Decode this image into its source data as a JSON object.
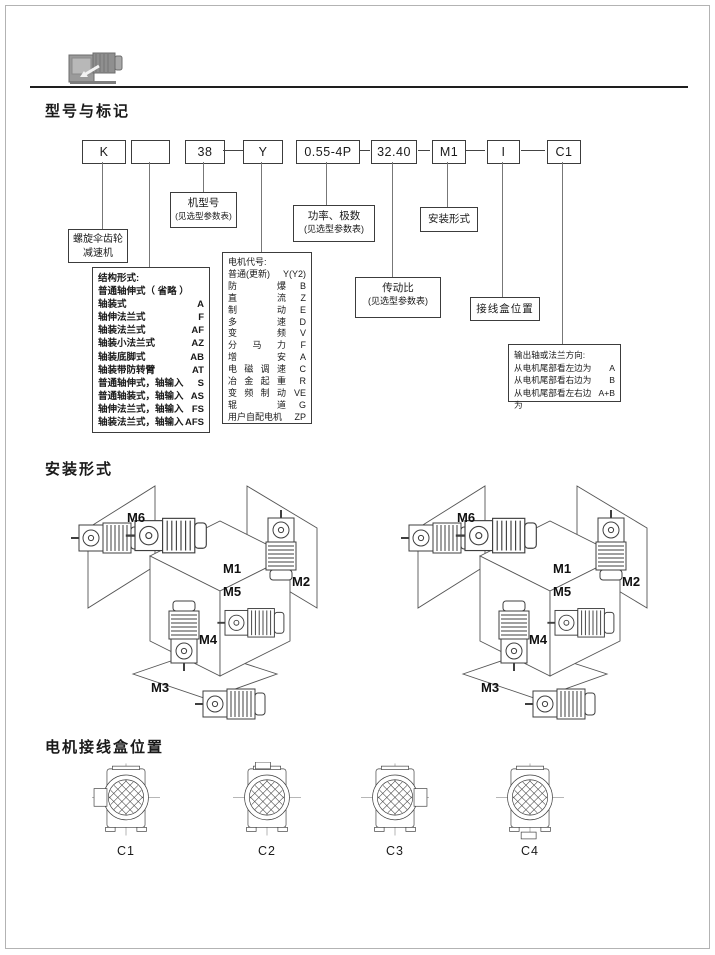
{
  "sections": {
    "model_marking_title": "型号与标记",
    "mounting_title": "安装形式",
    "terminal_title": "电机接线盒位置"
  },
  "model_code": {
    "boxes": [
      "K",
      "",
      "38",
      "Y",
      "0.55-4P",
      "32.40",
      "M1",
      "I",
      "C1"
    ]
  },
  "callouts": {
    "reducer": {
      "line1": "螺旋伞齿轮",
      "line2": "减速机"
    },
    "frame": {
      "line1": "机型号",
      "line2": "(见选型参数表)"
    },
    "power": {
      "line1": "功率、极数",
      "line2": "(见选型参数表)"
    },
    "mounting": "安装形式",
    "ratio": {
      "line1": "传动比",
      "line2": "(见选型参数表)"
    },
    "terminal": "接线盒位置",
    "output_dir": {
      "title": "输出轴或法兰方向:",
      "rows": [
        {
          "text": "从电机尾部看左边为",
          "code": "A"
        },
        {
          "text": "从电机尾部看右边为",
          "code": "B"
        },
        {
          "text": "从电机尾部看左右边为",
          "code": "A+B"
        }
      ]
    },
    "structure": {
      "title": "结构形式:",
      "subtitle": "普通轴伸式（ 省略 ）",
      "rows": [
        {
          "label": "轴装式",
          "code": "A"
        },
        {
          "label": "轴伸法兰式",
          "code": "F"
        },
        {
          "label": "轴装法兰式",
          "code": "AF"
        },
        {
          "label": "轴装小法兰式",
          "code": "AZ"
        },
        {
          "label": "轴装底脚式",
          "code": "AB"
        },
        {
          "label": "轴装带防转臂",
          "code": "AT"
        },
        {
          "label": "普通轴伸式，轴输入",
          "code": "S"
        },
        {
          "label": "普通轴装式，轴输入",
          "code": "AS"
        },
        {
          "label": "轴伸法兰式，轴输入",
          "code": "FS"
        },
        {
          "label": "轴装法兰式，轴输入",
          "code": "AFS"
        }
      ]
    },
    "motor": {
      "title": "电机代号:",
      "rows": [
        {
          "label": "普通(更新)",
          "code": "Y(Y2)"
        },
        {
          "label": "防爆",
          "code": "B"
        },
        {
          "label": "直流",
          "code": "Z"
        },
        {
          "label": "制动",
          "code": "E"
        },
        {
          "label": "多速",
          "code": "D"
        },
        {
          "label": "变频",
          "code": "V"
        },
        {
          "label": "分马力",
          "code": "F"
        },
        {
          "label": "增安",
          "code": "A"
        },
        {
          "label": "电磁调速",
          "code": "C"
        },
        {
          "label": "冶金起重",
          "code": "R"
        },
        {
          "label": "变频制动",
          "code": "VE"
        },
        {
          "label": "辊道",
          "code": "G"
        },
        {
          "label": "用户自配电机",
          "code": "ZP"
        }
      ]
    }
  },
  "mounting_positions": [
    "M1",
    "M2",
    "M3",
    "M4",
    "M5",
    "M6"
  ],
  "terminal_positions": [
    "C1",
    "C2",
    "C3",
    "C4"
  ]
}
